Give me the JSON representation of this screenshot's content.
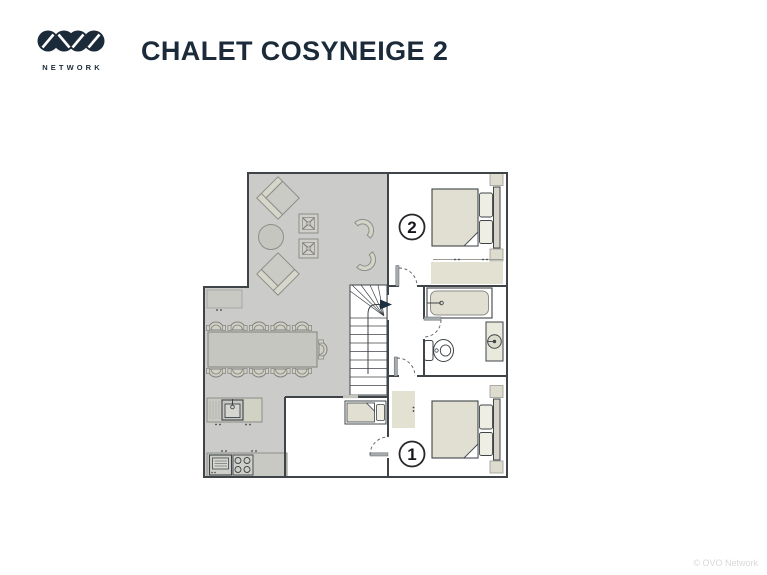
{
  "brand": {
    "monogram": "OVO",
    "wordmark": "NETWORK"
  },
  "header": {
    "title": "CHALET COSYNEIGE 2"
  },
  "floorplan": {
    "labels": {
      "bedroom1": "1",
      "bedroom2": "2"
    },
    "rooms": [
      "living-room",
      "dining-area",
      "kitchen",
      "staircase",
      "hallway",
      "bathroom",
      "bedroom-1",
      "bedroom-2",
      "bunk-room"
    ],
    "furniture": [
      "sofa",
      "sofa",
      "round-coffee-table",
      "cross-stool",
      "cross-stool",
      "lounge-chair",
      "lounge-chair",
      "dining-table",
      "dining-chair-x11",
      "sideboard",
      "kitchen-sink-counter",
      "oven",
      "cooktop",
      "staircase-up-arrow",
      "single-bed",
      "double-bed",
      "double-bed",
      "nightstand-x4",
      "wardrobe",
      "wardrobe",
      "bathtub",
      "toilet",
      "washbasin"
    ],
    "colors": {
      "floor": "#cbcbca",
      "walls": "#3f4449",
      "furniture_beige": "#e0dfd1",
      "furniture_grey": "#c9c9c3",
      "text_navy": "#1c2b3a",
      "door_arc": "#5a5f64"
    }
  },
  "footer": {
    "copyright": "© OVO Network"
  }
}
